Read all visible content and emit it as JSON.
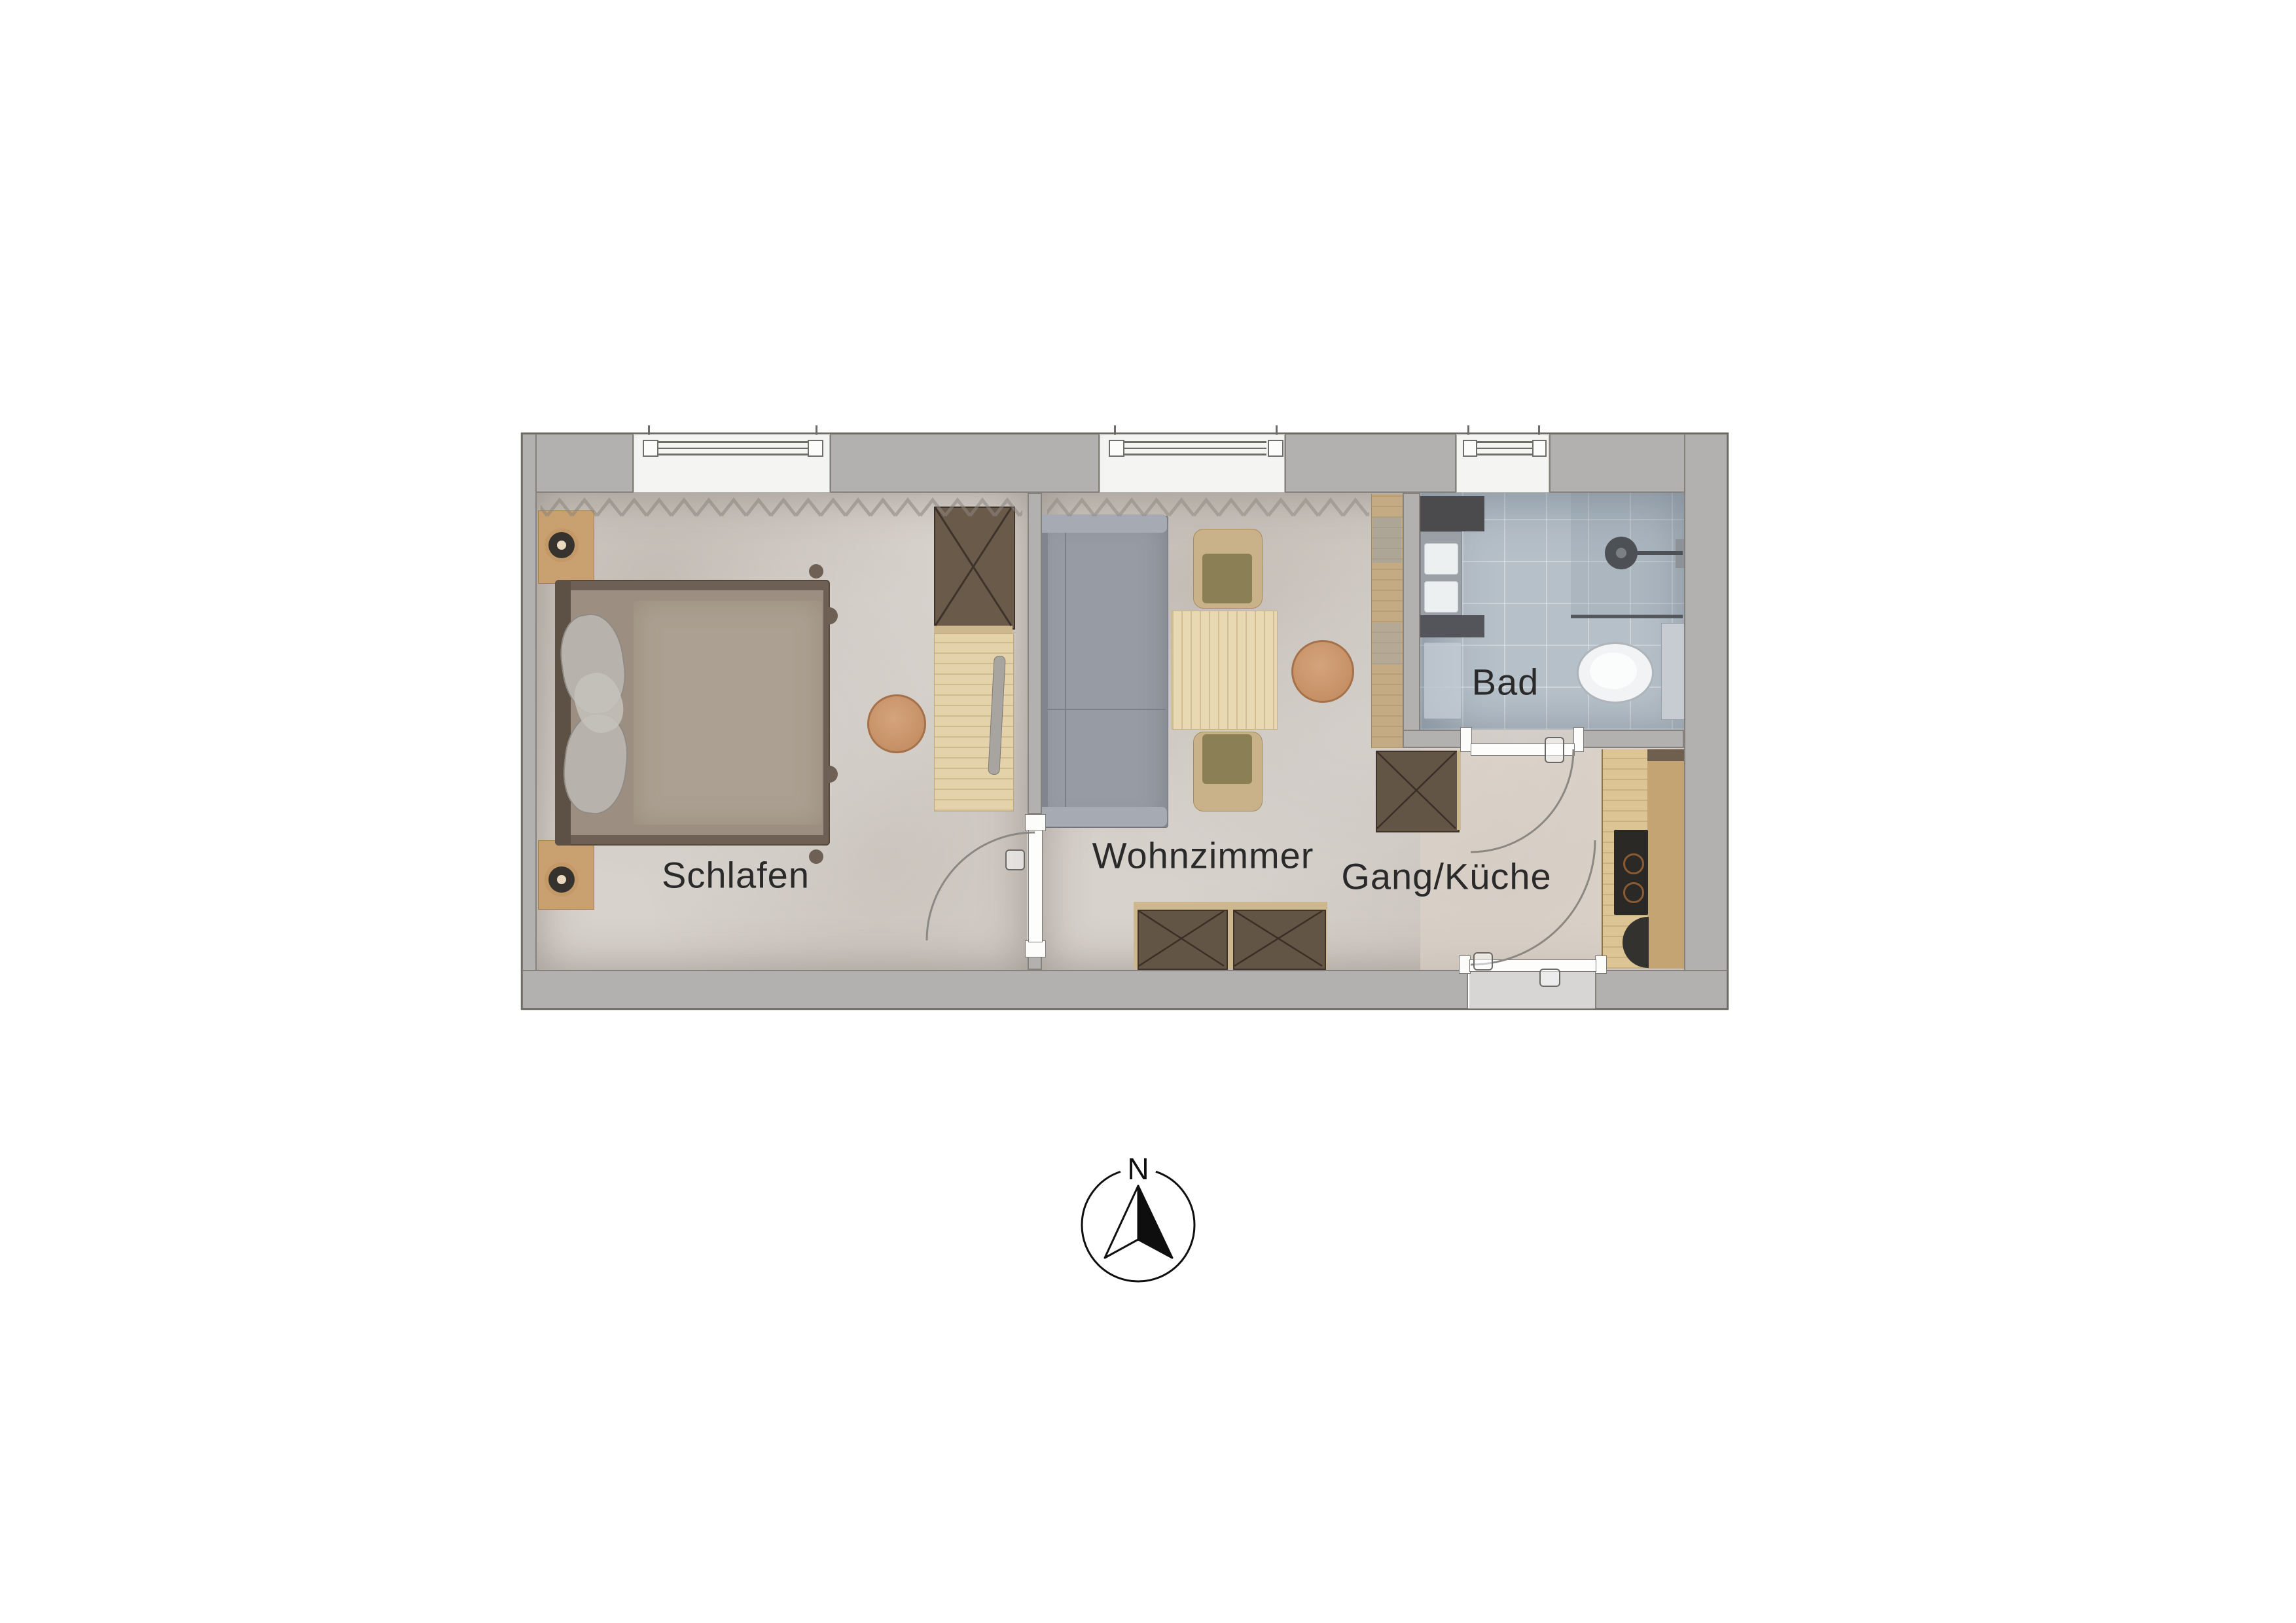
{
  "rooms": {
    "schlafen": {
      "label": "Schlafen"
    },
    "wohnzimmer": {
      "label": "Wohnzimmer"
    },
    "gang_kueche": {
      "label": "Gang/Küche"
    },
    "bad": {
      "label": "Bad"
    }
  },
  "compass": {
    "north_label": "N"
  },
  "colors": {
    "wall": "#b3b1af",
    "floor": "#d7d2cc",
    "bathroom_floor": "#b6c0c9",
    "cabinet_dark_wood": "#635546",
    "cabinet_trim": "#cdb78f",
    "light_wood": "#e3d2aa",
    "accent_tan": "#c69066",
    "sofa_gray": "#979ba3",
    "chair_olive": "#8b8055",
    "label_text": "#2a2a2a"
  }
}
